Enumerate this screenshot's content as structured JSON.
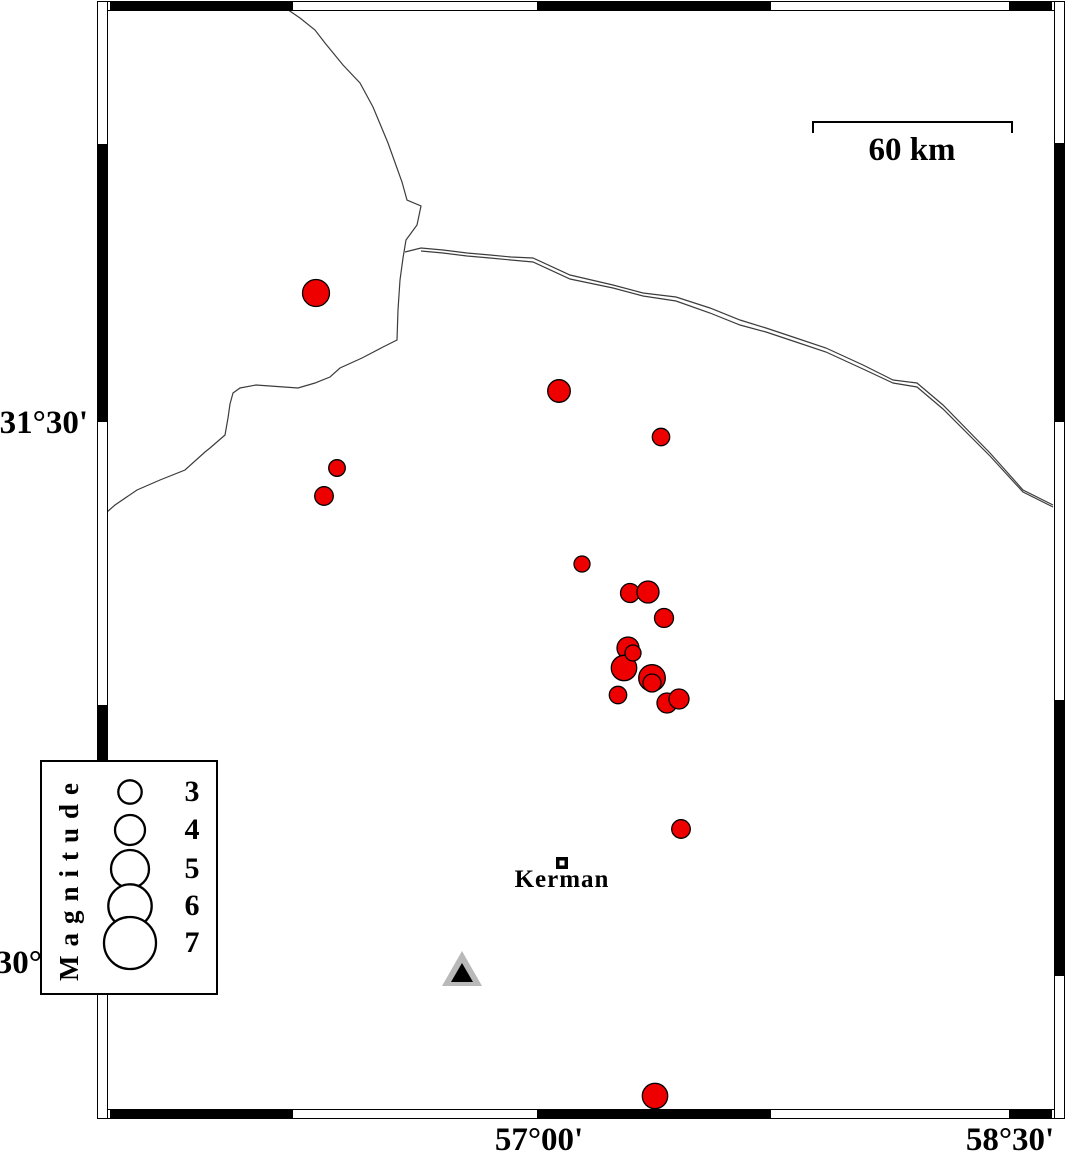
{
  "colors": {
    "earthquake_fill": "#ee0000",
    "outline": "#000000",
    "boundary_line": "#3c3c3c",
    "station_gray": "#b9b9b9",
    "background": "#ffffff"
  },
  "axis": {
    "lat_labels": [
      {
        "text": "31°30'",
        "y_center": 423
      },
      {
        "text": "30°",
        "y_center": 963
      }
    ],
    "lon_labels": [
      {
        "text": "57°00'",
        "x_center": 539
      },
      {
        "text": "58°30'",
        "x_center": 1010
      }
    ]
  },
  "scale_bar": {
    "label": "60 km",
    "x1": 813,
    "x2": 1012,
    "y": 122,
    "tick_drop": 11
  },
  "city": {
    "name": "Kerman",
    "x": 562,
    "y": 863,
    "outer_size": 12,
    "inner_size": 5
  },
  "station": {
    "outer_points": "462,951 442,986 482,986",
    "inner_points": "462,963 451,982 473,982"
  },
  "legend": {
    "title": "Magnitude",
    "circle_cx": 88,
    "items": [
      {
        "label": "3",
        "r": 11.7,
        "cy": 30
      },
      {
        "label": "4",
        "r": 15,
        "cy": 68
      },
      {
        "label": "5",
        "r": 19,
        "cy": 107
      },
      {
        "label": "6",
        "r": 21.7,
        "cy": 144
      },
      {
        "label": "7",
        "r": 26,
        "cy": 181
      }
    ]
  },
  "map": {
    "frame": {
      "outer_x": 97,
      "outer_y": 1,
      "outer_w": 968,
      "outer_h": 1118,
      "band": 11,
      "top_segments": [
        [
          110,
          293
        ],
        [
          537,
          771
        ],
        [
          1009,
          1052
        ]
      ],
      "bottom_segments": [
        [
          110,
          293
        ],
        [
          537,
          771
        ],
        [
          1009,
          1052
        ]
      ],
      "left_segments": [
        [
          144,
          422
        ],
        [
          705,
          976
        ]
      ],
      "right_segments": [
        [
          143,
          422
        ],
        [
          700,
          976
        ]
      ]
    },
    "boundary_lines": [
      {
        "points": "278,3 300,18 315,30 325,43 343,65 360,83 373,107 388,143 402,182 407,200 421,206 417,225 406,240 403,258 400,280 398,310 397,340 383,347 362,358 340,368 330,377 315,383 298,388 270,386 256,385 240,388 233,393 230,404 228,418 225,435 210,448 205,452 185,470 160,480 137,490 115,505 107,512"
      },
      {
        "points": "405,252 421,248 443,250 467,253 490,255 511,257 533,258 570,275 613,285 643,293 676,297 710,308 740,320 766,328 793,337 826,348 863,365 893,380 917,383 943,405 990,453 1023,490 1053,505"
      },
      {
        "points": "421,251 443,253 467,256 490,258 511,260 533,262 570,279 613,288 643,296 676,301 710,313 740,325 766,332 793,341 826,352 863,369 893,383 917,387 943,409 990,456 1023,492 1053,507"
      }
    ],
    "earthquakes": [
      {
        "cx": 316,
        "cy": 293,
        "r": 13.5
      },
      {
        "cx": 559,
        "cy": 391,
        "r": 11.3
      },
      {
        "cx": 661,
        "cy": 437,
        "r": 8.7
      },
      {
        "cx": 337,
        "cy": 468,
        "r": 8.3
      },
      {
        "cx": 324,
        "cy": 496,
        "r": 9.3
      },
      {
        "cx": 582,
        "cy": 564,
        "r": 8
      },
      {
        "cx": 630,
        "cy": 593,
        "r": 9.5
      },
      {
        "cx": 648,
        "cy": 592,
        "r": 11
      },
      {
        "cx": 664,
        "cy": 618,
        "r": 9.5
      },
      {
        "cx": 628,
        "cy": 648,
        "r": 11
      },
      {
        "cx": 624,
        "cy": 668,
        "r": 12.7
      },
      {
        "cx": 633,
        "cy": 653,
        "r": 8
      },
      {
        "cx": 652,
        "cy": 678,
        "r": 13.3
      },
      {
        "cx": 652,
        "cy": 683,
        "r": 9
      },
      {
        "cx": 618,
        "cy": 695,
        "r": 8.7
      },
      {
        "cx": 667,
        "cy": 703,
        "r": 10
      },
      {
        "cx": 679,
        "cy": 699,
        "r": 10
      },
      {
        "cx": 681,
        "cy": 829,
        "r": 9.3
      },
      {
        "cx": 655,
        "cy": 1096,
        "r": 12.7
      }
    ]
  }
}
